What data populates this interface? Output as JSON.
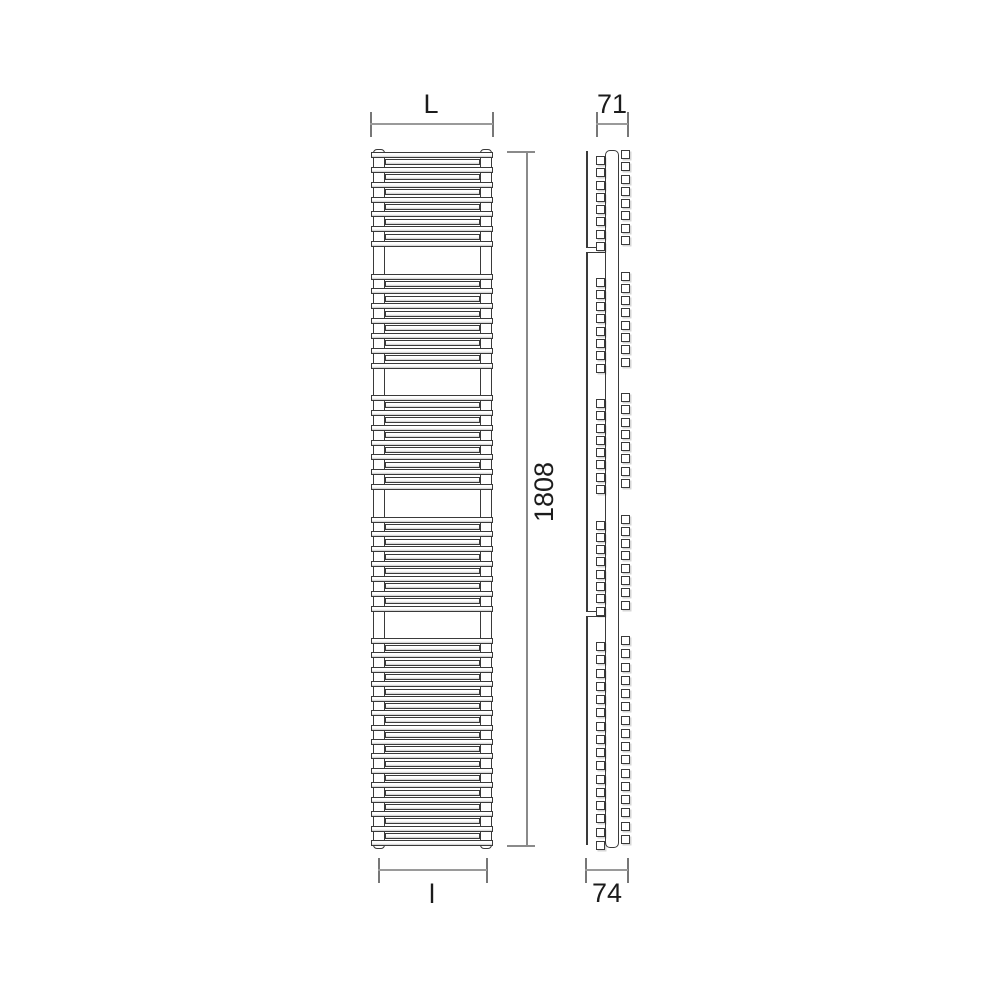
{
  "labels": {
    "width_top": "L",
    "depth_top": "71",
    "height": "1808",
    "width_bottom": "l",
    "depth_bottom": "74"
  },
  "colors": {
    "background": "#ffffff",
    "drawing_line": "#3a3a3a",
    "bar_shading": "#c7c7c7",
    "dimension_line": "#9a9a9a",
    "dimension_tick": "#777777",
    "label_text": "#1c1c1c"
  },
  "drawing": {
    "front": {
      "bar_x": 371,
      "bar_w": 122,
      "back_x": 385,
      "back_w": 95,
      "bar_h": 6,
      "collector_top": 149,
      "collector_bottom": 849,
      "collectors": [
        {
          "x": 373,
          "w": 12
        },
        {
          "x": 480,
          "w": 12
        }
      ],
      "groups": [
        {
          "top": 152,
          "height": 95,
          "front_bars": 7,
          "back_bars": 6
        },
        {
          "top": 273.5,
          "height": 95,
          "front_bars": 7,
          "back_bars": 6
        },
        {
          "top": 395,
          "height": 95,
          "front_bars": 7,
          "back_bars": 6
        },
        {
          "top": 516.5,
          "height": 95,
          "front_bars": 7,
          "back_bars": 6
        },
        {
          "top": 638,
          "height": 208,
          "front_bars": 15,
          "back_bars": 14
        }
      ]
    },
    "side": {
      "wall_x": 586,
      "wall_top": 151,
      "wall_bottom": 845,
      "collector_x": 605,
      "collector_w": 14,
      "collector_top": 150,
      "collector_bottom": 848,
      "left_col_x": 596,
      "right_col_x": 621,
      "square": 9,
      "brackets": [
        {
          "y": 247
        },
        {
          "y": 611
        }
      ],
      "groups": [
        {
          "top": 152,
          "height": 95,
          "squares": 8
        },
        {
          "top": 273.5,
          "height": 95,
          "squares": 8
        },
        {
          "top": 395,
          "height": 95,
          "squares": 8
        },
        {
          "top": 516.5,
          "height": 95,
          "squares": 8
        },
        {
          "top": 638,
          "height": 208,
          "squares": 16
        }
      ]
    }
  }
}
